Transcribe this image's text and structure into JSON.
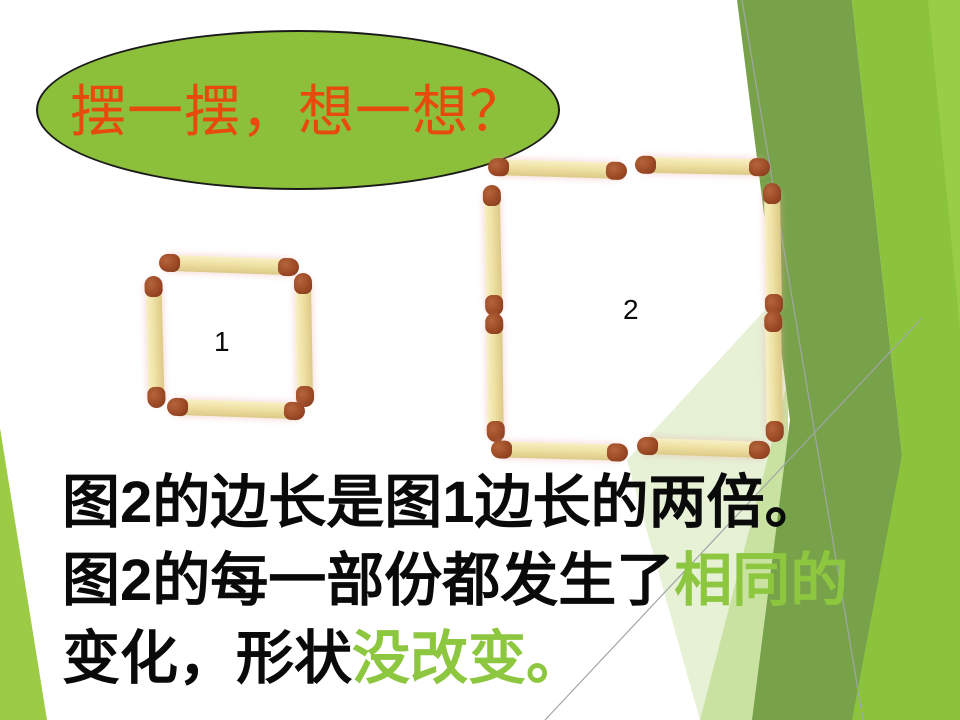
{
  "title_banner": {
    "text": "摆一摆，想一想？"
  },
  "figures": {
    "figure1_label": "1",
    "figure1_matchsticks": 4,
    "figure2_label": "2",
    "figure2_matchsticks": 8
  },
  "body_text": {
    "line1": "图2的边长是图1边长的两倍。",
    "line2_black": "图2的每一部份都发生了",
    "line2_highlight": "相同的",
    "line3_black": "变化，形状",
    "line3_highlight": "没改变。"
  },
  "colors": {
    "banner-fill": "#8CBF3A",
    "banner-text": "#E8490F",
    "highlight-green": "#8DC63F",
    "body-text-color": "#0A0A0A",
    "decor-dark-green": "#77A24A",
    "decor-bright-green": "#8CC33C",
    "decor-bright-green-2": "#99CD48",
    "decor-pale-green": "#E6F1D6",
    "decor-pale-green-2": "#C9E2A2",
    "decor-left-wedge": "#9CCB45",
    "decor-line": "#A0A6A6",
    "match-body": "#EFE2A4",
    "match-head": "#9C4A26"
  }
}
